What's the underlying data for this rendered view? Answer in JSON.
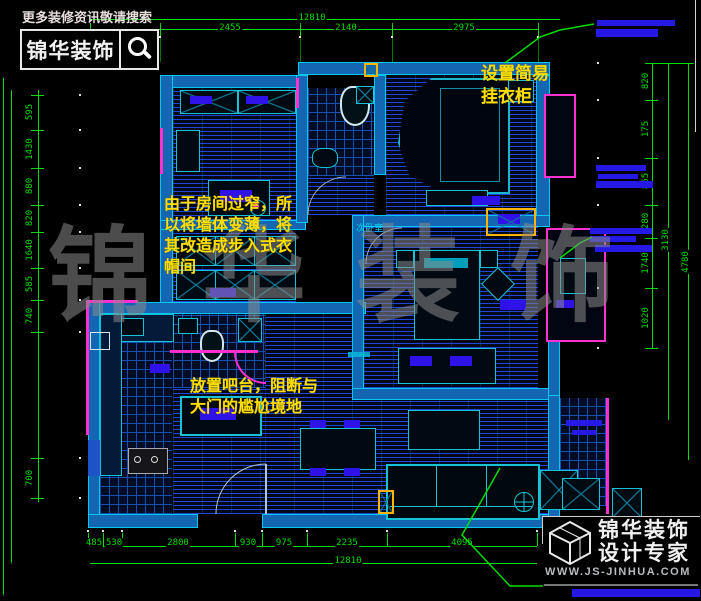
{
  "header": {
    "tagline": "更多装修资讯敬请搜索",
    "brand": "锦华装饰"
  },
  "watermark": "锦华装饰",
  "annotations": {
    "closet_note": [
      "设置简易",
      "挂衣柜"
    ],
    "wardrobe_note": [
      "由于房间过窄，所",
      "以将墙体变薄，将",
      "其改造成步入式衣",
      "帽间"
    ],
    "bar_note": [
      "放置吧台，阻断与",
      "大门的尴尬境地"
    ]
  },
  "room_labels": {
    "secondary_bedroom": "次卧室"
  },
  "dimensions": {
    "top": {
      "total": "12810",
      "segments": [
        "2455",
        "2140",
        "2975"
      ]
    },
    "bottom": {
      "total": "12810",
      "segments": [
        "485",
        "530",
        "2800",
        "930",
        "975",
        "2235",
        "4095"
      ]
    },
    "left": [
      "595",
      "1430",
      "880",
      "820",
      "1640",
      "585",
      "740",
      "700"
    ],
    "right": [
      "820",
      "175",
      "865",
      "280",
      "1740",
      "1020",
      "3130",
      "4780"
    ]
  },
  "footer": {
    "brand_line1": "锦华装饰",
    "brand_line2": "设计专家",
    "website": "WWW.JS-JINHUA.COM"
  },
  "colors": {
    "dim_green": "#00dc00",
    "wall_blue": "#1566b2",
    "hatch_line": "#1e46d7",
    "cyan": "#00e0ff",
    "magenta": "#ff2fd0",
    "note_yellow": "#ffdf00",
    "vent_blue": "#2f12e8",
    "highlight_orange": "#ffb400"
  }
}
